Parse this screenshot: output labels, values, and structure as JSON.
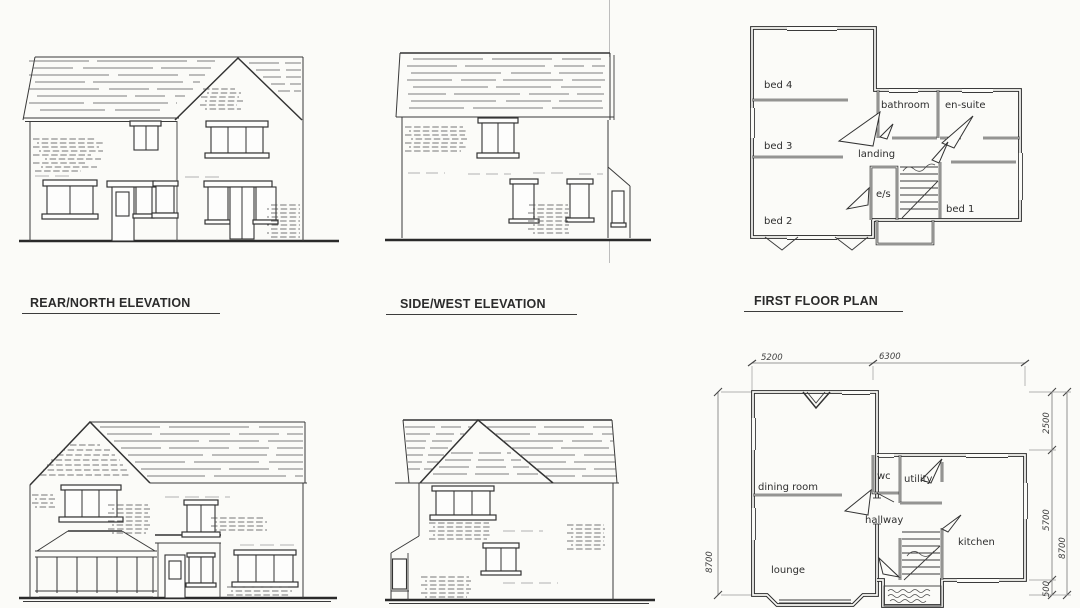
{
  "sheet": {
    "background": "#fbfbf8",
    "ink": "#3a3a3a",
    "titles": {
      "rear_north": "REAR/NORTH ELEVATION",
      "side_west": "SIDE/WEST ELEVATION",
      "first_floor": "FIRST FLOOR PLAN"
    }
  },
  "first_floor_plan": {
    "rooms": {
      "bed4": "bed 4",
      "bed3": "bed 3",
      "bed2": "bed 2",
      "bathroom": "bathroom",
      "ensuite": "en-suite",
      "landing": "landing",
      "es": "e/s",
      "bed1": "bed 1"
    }
  },
  "ground_floor_plan": {
    "rooms": {
      "dining_room": "dining room",
      "wc": "wc",
      "utility": "utility",
      "hallway": "hallway",
      "lounge": "lounge",
      "kitchen": "kitchen"
    },
    "dimensions": {
      "width_left": "5200",
      "width_right": "6300",
      "right_top": "2500",
      "right_middle": "5700",
      "right_bottom": "500",
      "right_total": "8700",
      "left_total": "8700"
    }
  }
}
